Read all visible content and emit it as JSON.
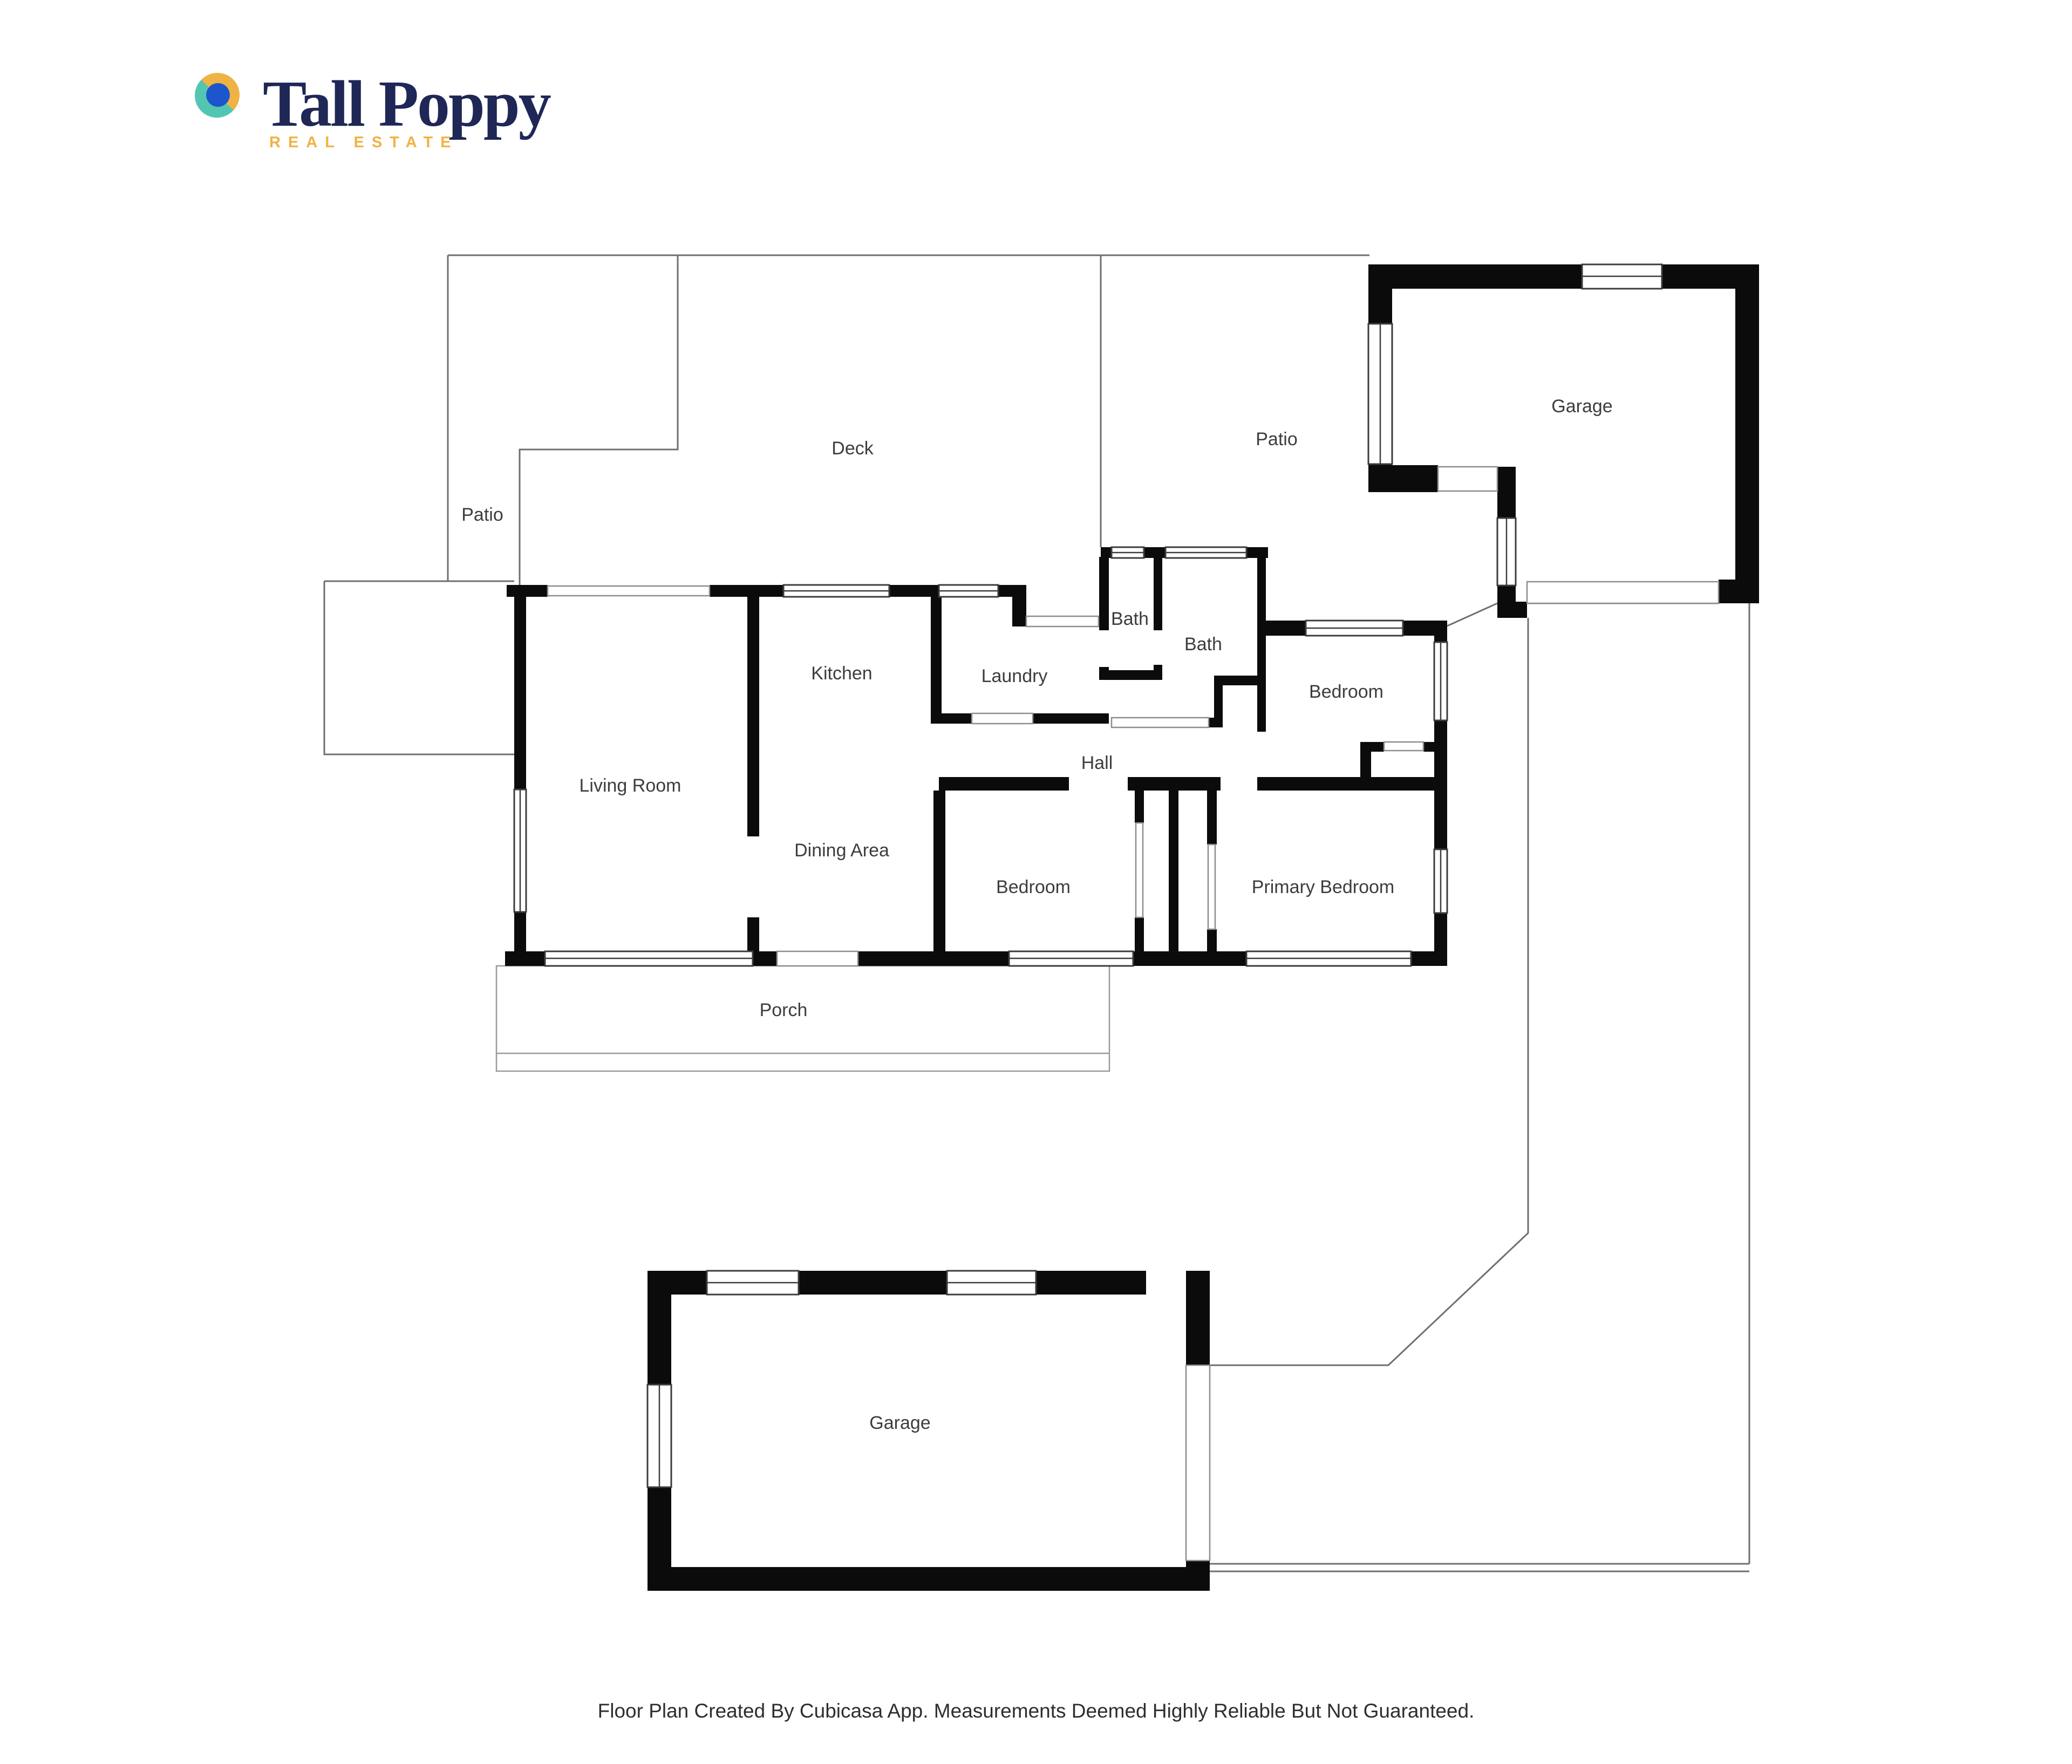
{
  "logo": {
    "title": "Tall Poppy",
    "subtitle": "REAL ESTATE",
    "icon": "circle-mark"
  },
  "colors": {
    "navy": "#1f2757",
    "gold": "#efb345",
    "teal": "#53c6b1",
    "blue": "#1d55cd",
    "wall": "#0b0b0b",
    "outline": "#6f6f6f",
    "label": "#3d3d3d"
  },
  "rooms": {
    "deck": {
      "label": "Deck"
    },
    "patio_left": {
      "label": "Patio"
    },
    "patio_right": {
      "label": "Patio"
    },
    "garage_top": {
      "label": "Garage"
    },
    "bath_small": {
      "label": "Bath"
    },
    "bath_main": {
      "label": "Bath"
    },
    "kitchen": {
      "label": "Kitchen"
    },
    "laundry": {
      "label": "Laundry"
    },
    "bedroom_ne": {
      "label": "Bedroom"
    },
    "living_room": {
      "label": "Living Room"
    },
    "hall": {
      "label": "Hall"
    },
    "dining_area": {
      "label": "Dining Area"
    },
    "bedroom_front": {
      "label": "Bedroom"
    },
    "primary_bedroom": {
      "label": "Primary Bedroom"
    },
    "porch": {
      "label": "Porch"
    },
    "garage_bottom": {
      "label": "Garage"
    }
  },
  "footer": {
    "disclaimer": "Floor Plan Created By Cubicasa App. Measurements Deemed Highly Reliable But Not Guaranteed."
  }
}
